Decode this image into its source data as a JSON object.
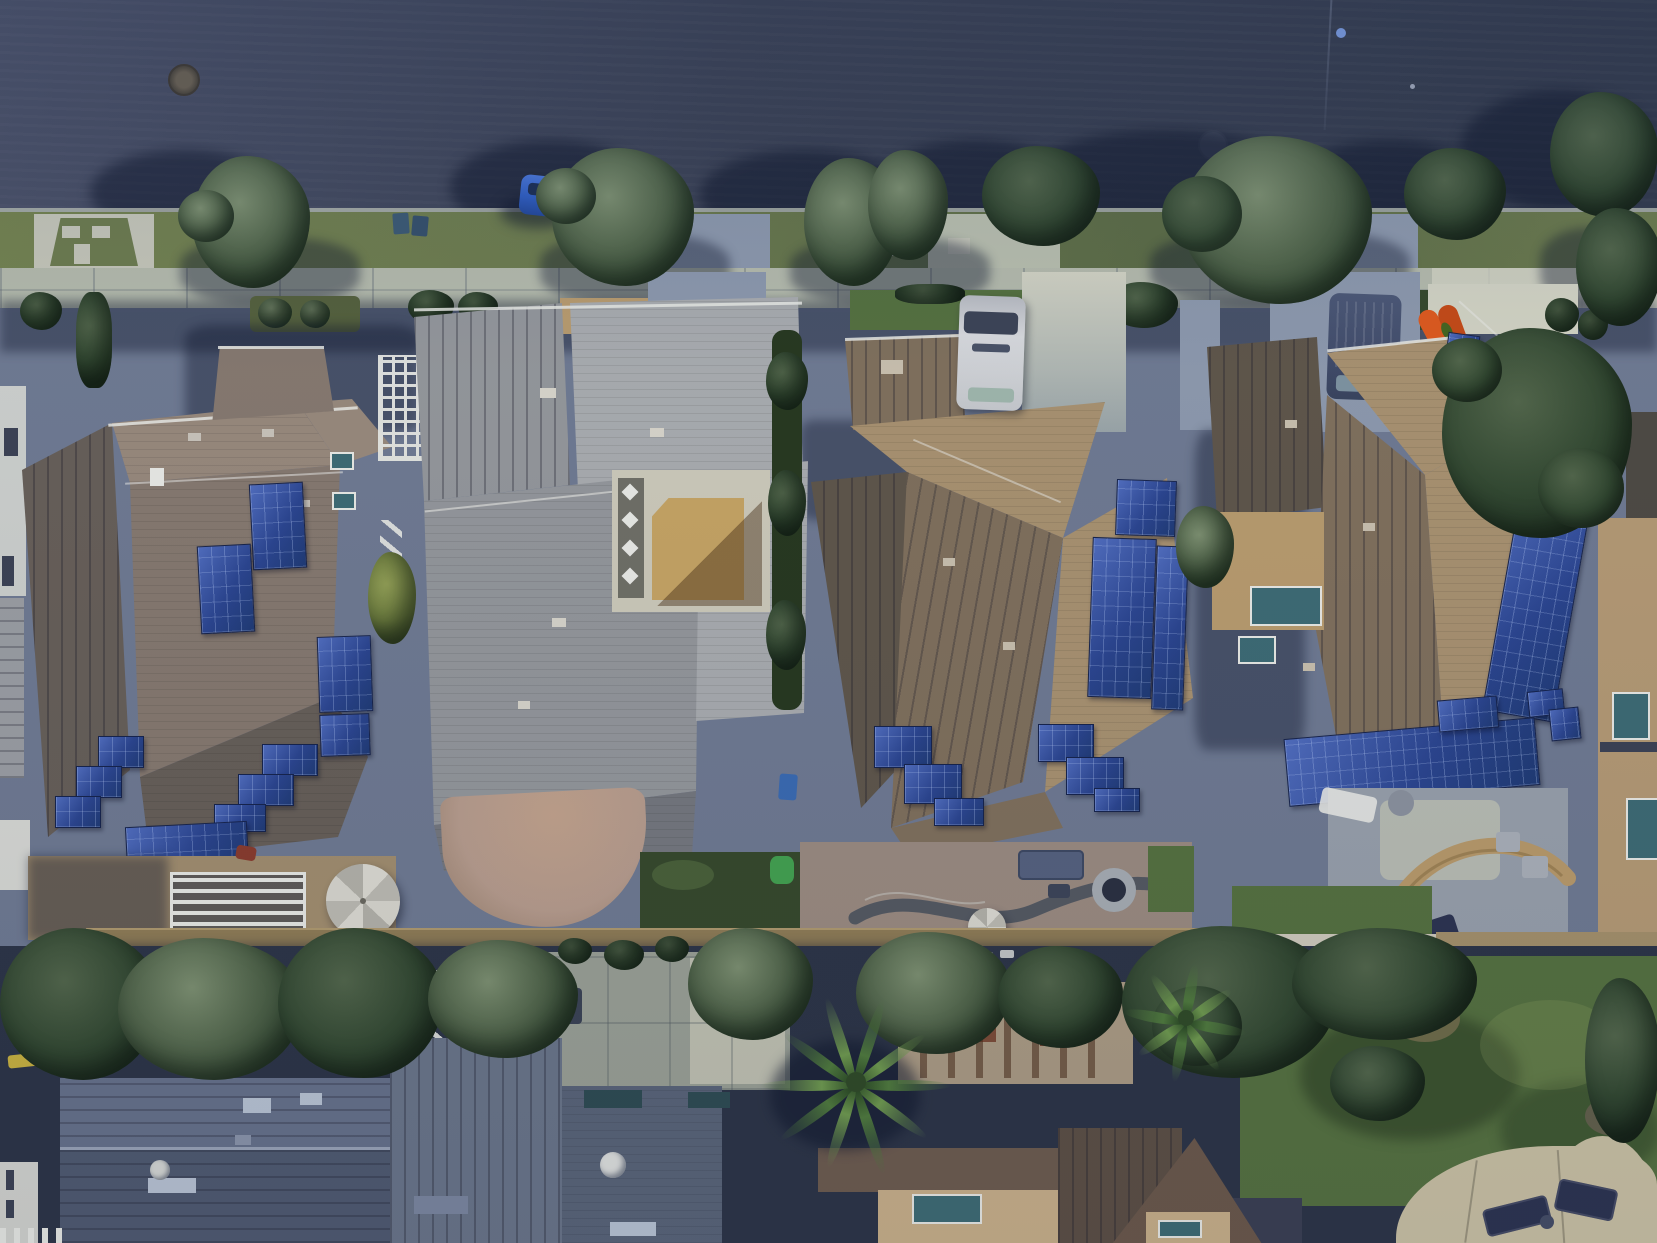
{
  "image": {
    "kind": "aerial-drone-photograph",
    "description": "Top-down daytime aerial view of a suburban residential street: a dark asphalt road along the top, a concrete sidewalk with parkway grass and street trees, a row of four large single-family homes (several with blue rooftop solar-panel arrays), rear patios and backyards with dense trees, palm trees and a large lawn at the bottom.",
    "orientation": "top-down",
    "width_px": 1657,
    "height_px": 1243
  },
  "palette": {
    "road": "#3a4154",
    "road-light": "#4a5168",
    "road-dark": "#323a4c",
    "curb": "#b9bfb4",
    "sidewalk": "#b5bbac",
    "concrete": "#c6c7b9",
    "concrete-sun": "#d3d4c4",
    "concrete-shade": "#8d99ad",
    "grass": "#6d7c4e",
    "lawn": "#55713f",
    "lawn-dark": "#36492b",
    "tree-dark": "#324830",
    "tree-mid": "#52664a",
    "tree-light": "#7d9070",
    "tree-yellow": "#93a055",
    "roof1": "#86796f",
    "roof1-light": "#98897c",
    "roof1-dark": "#675f58",
    "roof2": "#94979b",
    "roof2-light": "#a9acaf",
    "roof2-dark": "#75787e",
    "roof3": "#93826d",
    "roof3-light": "#a99270",
    "roof3-mid": "#80705c",
    "roof3-dark": "#5f564a",
    "solar": "#2b4590",
    "solar-edge": "#16234c",
    "court-tan": "#c6a463",
    "court-brown": "#91713f",
    "court-concrete": "#cdcaba",
    "pebble": "#6f6f66",
    "paver": "#b89d8d",
    "dirt": "#a28e6e",
    "white-trim": "#e9eae5",
    "van-white": "#d9dbde",
    "van-dark": "#424d6b",
    "car-blue": "#2f5ec2",
    "kayak": "#df5a1d",
    "bin": "#3c5a74",
    "bin-blue": "#3a6ab2",
    "slide-green": "#43a24f",
    "wall-tan": "#8f7c55",
    "walk-white": "#cfcabb",
    "byroof-a": "#66718a",
    "byroof-b": "#4f5a70",
    "byroof-c": "#6a7589",
    "byroof-d": "#596478",
    "byroof-brown": "#5c4f44",
    "byroof-tan": "#c9b089",
    "skylight": "#2e4b52",
    "window-light": "#b9c4d4",
    "glass-teal": "#3d6b74",
    "patio-sand": "#cbc2a4",
    "chaise": "#2c3350",
    "fire-ring": "#a7adb3",
    "serp": "#4e555e",
    "bench-tan": "#b99a6a",
    "yellow-obj": "#c8b13f"
  },
  "scene": {
    "street": {
      "surface": "asphalt",
      "features": [
        "manhole-cover",
        "faint-manhole-cover",
        "blue-reflector-dot",
        "hairline-crack"
      ],
      "parked_vehicles": [
        {
          "type": "car",
          "color": "blue",
          "location": "curb under street tree"
        },
        {
          "type": "van",
          "color": "dark-gray",
          "location": "right driveway"
        }
      ]
    },
    "parkway": {
      "street_trees": 9,
      "trash_bins": 4,
      "driveway_aprons": 4,
      "utility_pads": 2,
      "grass": "olive strip"
    },
    "sidewalk": {
      "material": "concrete",
      "joint_lines": true
    },
    "houses": [
      {
        "id": 1,
        "roof": "brown-gray hip roof",
        "solar_panel_groups": 6,
        "features": [
          "white-trellis",
          "front-porch-roof",
          "louvered-pergola",
          "patio-umbrella",
          "dirt-backyard"
        ]
      },
      {
        "id": 2,
        "roof": "light-gray hip roof",
        "solar_panel_groups": 0,
        "features": [
          "central-courtyard-tan-floor",
          "pebble-border-with-diamond-pavers",
          "curved-paver-patio",
          "rear-lawn",
          "green-play-slide",
          "blue-recycle-bin"
        ]
      },
      {
        "id": 3,
        "roof": "tan hip roof",
        "solar_panel_groups": 4,
        "features": [
          "white-van-in-driveway",
          "paver-patio",
          "serpentine-wall",
          "fire-pit",
          "patio-umbrella",
          "outdoor-sofa"
        ]
      },
      {
        "id": 4,
        "roof": "tan hip roof",
        "solar_panel_groups": 5,
        "features": [
          "entry-courtyard",
          "curved-bench-patio",
          "lounge-chairs",
          "rear-lawn",
          "orange-kayak-by-driveway"
        ]
      }
    ],
    "backyards": {
      "tree_belt": "dense shadowed trees across rear property line",
      "palm_trees": 2,
      "white_lattice_fence": true,
      "satellite_dishes": 2,
      "rear_houses": 5,
      "large_lawn": "bottom-right",
      "scalloped_concrete_patio": "bottom-right with two dark lounge chairs",
      "misc": [
        "concrete-patio",
        "red-paver-squares",
        "wood-pergola-shadow",
        "yellow-object",
        "white-slat-fence"
      ]
    }
  }
}
